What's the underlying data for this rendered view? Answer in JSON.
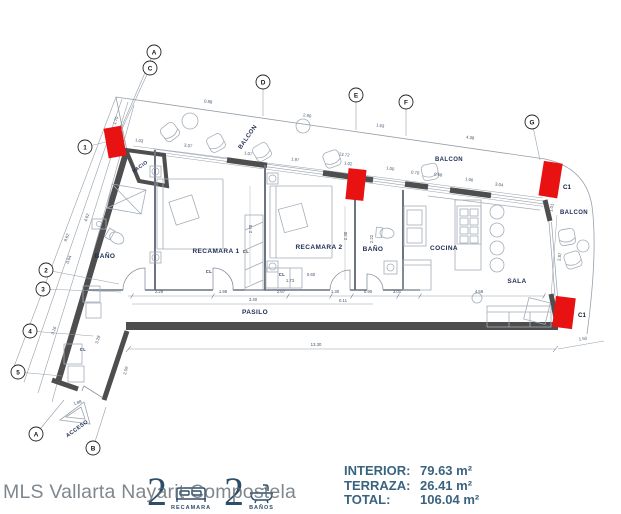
{
  "watermark": "MLS Vallarta Nayarit Compostela",
  "legend": {
    "bedrooms_count": "2",
    "bedrooms_label": "RECAMARA",
    "bathrooms_count": "2",
    "bathrooms_label": "BAÑOS"
  },
  "areas": {
    "rows": [
      {
        "label": "INTERIOR:",
        "value": "79.63 m²"
      },
      {
        "label": "TERRAZA:",
        "value": "26.41 m²"
      },
      {
        "label": "TOTAL:",
        "value": "106.04 m²"
      }
    ]
  },
  "colors": {
    "accent_red": "#e91212",
    "wall_dark": "#4e4e4e",
    "label_navy": "#1d2c52",
    "stats_blue": "#3a637f",
    "line_gray": "#95a0ab"
  },
  "plan": {
    "room_labels": [
      {
        "t": "VACIO",
        "x": 141,
        "y": 168,
        "r": -36,
        "s": 5,
        "c": "#3f4856"
      },
      {
        "t": "BAÑO",
        "x": 105,
        "y": 258,
        "s": 6.5
      },
      {
        "t": "RECAMARA 1",
        "x": 216,
        "y": 253,
        "s": 6.5
      },
      {
        "t": "RECAMARA 2",
        "x": 319,
        "y": 249,
        "s": 6.5
      },
      {
        "t": "BAÑO",
        "x": 373,
        "y": 251,
        "s": 6.5
      },
      {
        "t": "COCINA",
        "x": 444,
        "y": 250,
        "s": 6.5
      },
      {
        "t": "SALA",
        "x": 517,
        "y": 283,
        "s": 6.5
      },
      {
        "t": "PASILO",
        "x": 255,
        "y": 314,
        "s": 6.5
      },
      {
        "t": "BALCON",
        "x": 249,
        "y": 138,
        "r": -55,
        "s": 6
      },
      {
        "t": "BALCON",
        "x": 449,
        "y": 161,
        "s": 6
      },
      {
        "t": "BALCON",
        "x": 574,
        "y": 214,
        "s": 6
      },
      {
        "t": "ACCESO",
        "x": 78,
        "y": 430,
        "r": -36,
        "s": 5.5,
        "c": "#8b959e"
      },
      {
        "t": "CL",
        "x": 246,
        "y": 253,
        "s": 4.2,
        "c": "#4a5568"
      },
      {
        "t": "CL",
        "x": 209,
        "y": 273,
        "s": 4.2,
        "c": "#4a5568"
      },
      {
        "t": "CL",
        "x": 282,
        "y": 276,
        "s": 4.2,
        "c": "#4a5568"
      },
      {
        "t": "CL",
        "x": 83,
        "y": 351,
        "s": 4.2,
        "c": "#4a5568"
      }
    ],
    "grid_bubbles": [
      {
        "t": "A",
        "x": 154,
        "y": 52,
        "lx": 122,
        "ly": 126
      },
      {
        "t": "C",
        "x": 150,
        "y": 68,
        "lx": 121,
        "ly": 131
      },
      {
        "t": "D",
        "x": 263,
        "y": 82,
        "lx": 263,
        "ly": 116
      },
      {
        "t": "E",
        "x": 356,
        "y": 95,
        "lx": 356,
        "ly": 130
      },
      {
        "t": "F",
        "x": 406,
        "y": 102,
        "lx": 406,
        "ly": 136
      },
      {
        "t": "G",
        "x": 532,
        "y": 122,
        "lx": 540,
        "ly": 160
      },
      {
        "t": "1",
        "x": 85,
        "y": 147,
        "lx": 106,
        "ly": 142
      },
      {
        "t": "2",
        "x": 46,
        "y": 270,
        "lx": 119,
        "ly": 284
      },
      {
        "t": "3",
        "x": 43,
        "y": 289,
        "lx": 121,
        "ly": 292
      },
      {
        "t": "4",
        "x": 30,
        "y": 331,
        "lx": 93,
        "ly": 336
      },
      {
        "t": "5",
        "x": 18,
        "y": 372,
        "lx": 62,
        "ly": 376
      },
      {
        "t": "A",
        "x": 36,
        "y": 434,
        "lx": 64,
        "ly": 400
      },
      {
        "t": "B",
        "x": 93,
        "y": 448,
        "lx": 106,
        "ly": 407
      }
    ],
    "dimensions": [
      {
        "t": "0.88",
        "x": 208,
        "y": 103,
        "r": 8
      },
      {
        "t": "2.90",
        "x": 307,
        "y": 117,
        "r": 8
      },
      {
        "t": "1.63",
        "x": 380,
        "y": 127,
        "r": 8
      },
      {
        "t": "4.38",
        "x": 470,
        "y": 139,
        "r": 8
      },
      {
        "t": "1.70",
        "x": 117,
        "y": 121,
        "r": -70
      },
      {
        "t": "1.03",
        "x": 139,
        "y": 142,
        "r": 8
      },
      {
        "t": "3.37",
        "x": 188,
        "y": 147,
        "r": 8
      },
      {
        "t": "1.07",
        "x": 248,
        "y": 155,
        "r": 8
      },
      {
        "t": "1.97",
        "x": 295,
        "y": 161,
        "r": 8
      },
      {
        "t": "13.72",
        "x": 344,
        "y": 156,
        "r": 8
      },
      {
        "t": "1.02",
        "x": 348,
        "y": 165,
        "r": 8
      },
      {
        "t": "1.00",
        "x": 390,
        "y": 170,
        "r": 8
      },
      {
        "t": "0.70",
        "x": 415,
        "y": 174,
        "r": 8
      },
      {
        "t": "0.68",
        "x": 438,
        "y": 176,
        "r": 8
      },
      {
        "t": "1.06",
        "x": 469,
        "y": 181,
        "r": 8
      },
      {
        "t": "3.04",
        "x": 499,
        "y": 186,
        "r": 8
      },
      {
        "t": "4.62",
        "x": 88,
        "y": 218,
        "r": -70
      },
      {
        "t": "9.62",
        "x": 68,
        "y": 238,
        "r": -70
      },
      {
        "t": "0.04",
        "x": 70,
        "y": 260,
        "r": -70
      },
      {
        "t": "3.16",
        "x": 55,
        "y": 331,
        "r": -70
      },
      {
        "t": "3.28",
        "x": 99,
        "y": 340,
        "r": -75
      },
      {
        "t": "2.59",
        "x": 127,
        "y": 371,
        "r": -75
      },
      {
        "t": "1.88",
        "x": 78,
        "y": 404,
        "r": -20
      },
      {
        "t": "2.29",
        "x": 159,
        "y": 293
      },
      {
        "t": "1.98",
        "x": 223,
        "y": 293
      },
      {
        "t": "2.67",
        "x": 281,
        "y": 293
      },
      {
        "t": "3.40",
        "x": 253,
        "y": 301
      },
      {
        "t": "1.30",
        "x": 335,
        "y": 293
      },
      {
        "t": "0.90",
        "x": 368,
        "y": 293
      },
      {
        "t": "3.01",
        "x": 397,
        "y": 293
      },
      {
        "t": "4.58",
        "x": 479,
        "y": 293
      },
      {
        "t": "0.11",
        "x": 343,
        "y": 302
      },
      {
        "t": "1.73",
        "x": 290,
        "y": 282
      },
      {
        "t": "0.60",
        "x": 311,
        "y": 276
      },
      {
        "t": "2.70",
        "x": 252,
        "y": 229,
        "r": -90
      },
      {
        "t": "2.30",
        "x": 347,
        "y": 236,
        "r": -90
      },
      {
        "t": "2.22",
        "x": 373,
        "y": 239,
        "r": -90
      },
      {
        "t": "13.30",
        "x": 316,
        "y": 346
      },
      {
        "t": "1.50",
        "x": 583,
        "y": 340,
        "r": -6
      },
      {
        "t": "2.87",
        "x": 561,
        "y": 257,
        "r": -82
      },
      {
        "t": "1.01",
        "x": 553,
        "y": 208,
        "r": -80
      }
    ],
    "markers": [
      {
        "t": "C1",
        "x": 563,
        "y": 189
      },
      {
        "t": "C1",
        "x": 578,
        "y": 317
      }
    ]
  }
}
